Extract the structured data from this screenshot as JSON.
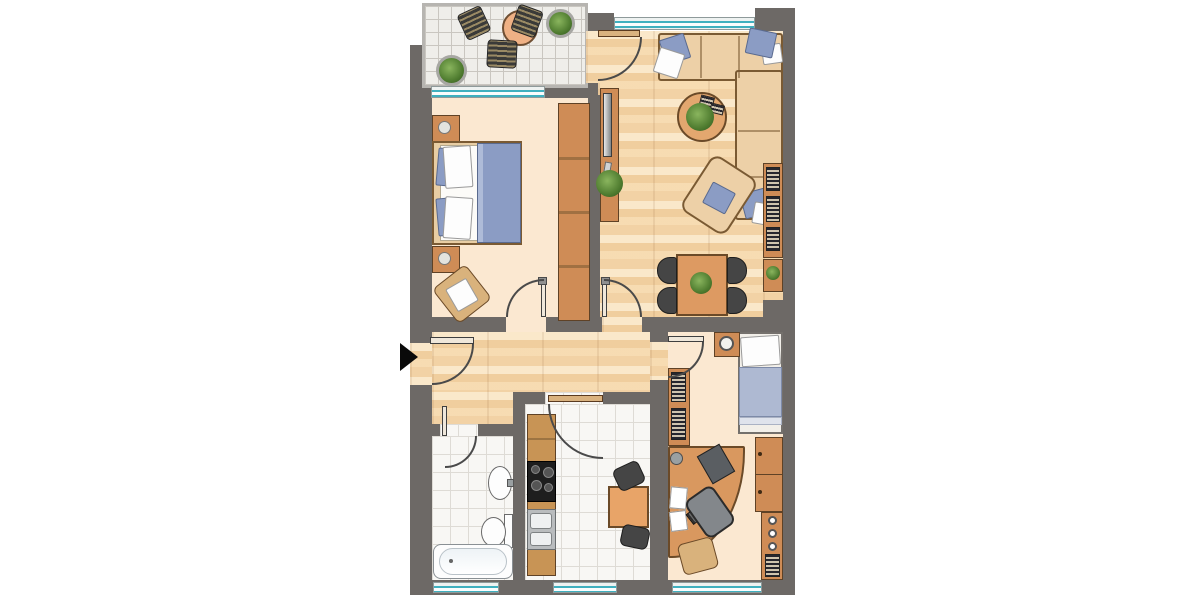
{
  "colors": {
    "wall": "#6d6966",
    "floor_cream": "#fbe8d1",
    "wood": "#f4d6ab",
    "tile": "#f8f7f4",
    "tile_line": "#dedbd5",
    "balcony_tile": "#efeeea",
    "balcony_line": "#c9c6c0",
    "window_glass": "#3fb0bf",
    "furniture_wood": "#cf8c56",
    "furniture_wood_dark": "#5f4226",
    "sofa": "#edd0a7",
    "sofa_outline": "#7a5a33",
    "textile_blue": "#8b9cc4",
    "appliance_gray": "#b9bcbe",
    "stove_black": "#1e1e1e",
    "chair_dark": "#454545",
    "table_peach": "#efb185",
    "plant_green": "#4e7b2f",
    "entrance_arrow": "#0a0a0a"
  },
  "plan": {
    "type": "apartment-floor-plan",
    "entrance_marker": "black-right-arrow",
    "rooms": [
      {
        "id": "balcony",
        "floor": "gray-tiles",
        "furniture": [
          "round-table",
          "wicker-chair",
          "wicker-chair",
          "wicker-chair",
          "potted-plant",
          "potted-plant"
        ]
      },
      {
        "id": "bedroom",
        "floor": "cream",
        "features": [
          "window",
          "door-to-hall"
        ],
        "furniture": [
          "double-bed",
          "pillows",
          "blue-blanket",
          "nightstand-with-lamp",
          "nightstand-with-lamp",
          "wicker-armchair",
          "wardrobe-four-sections"
        ]
      },
      {
        "id": "living-room",
        "floor": "wood-planks",
        "features": [
          "window",
          "balcony-door",
          "door-to-hall"
        ],
        "furniture": [
          "corner-sofa",
          "cushions",
          "round-coffee-table-with-plant",
          "books",
          "armchair",
          "tv-sideboard",
          "tv",
          "remote",
          "floor-plant",
          "bookshelf",
          "side-table-with-plant",
          "dining-table-with-plant",
          "dining-chair",
          "dining-chair",
          "dining-chair",
          "dining-chair"
        ]
      },
      {
        "id": "hallway",
        "floor": "wood-planks",
        "features": [
          "entrance-door"
        ]
      },
      {
        "id": "bathroom",
        "floor": "white-tiles",
        "features": [
          "window",
          "door"
        ],
        "furniture": [
          "washbasin",
          "toilet",
          "bathtub"
        ]
      },
      {
        "id": "kitchen",
        "floor": "white-tiles",
        "features": [
          "window",
          "door"
        ],
        "furniture": [
          "kitchenette-counter",
          "stove-four-burners",
          "double-sink",
          "square-table",
          "chair",
          "chair"
        ]
      },
      {
        "id": "office-bedroom",
        "floor": "cream",
        "features": [
          "window",
          "door"
        ],
        "furniture": [
          "single-bed",
          "nightstand-with-round-lamp",
          "bookshelf",
          "corner-desk",
          "monitor",
          "keyboard",
          "papers",
          "desk-lamp",
          "office-chair",
          "stool",
          "cabinet",
          "cabinet",
          "shelf-with-knobs"
        ]
      }
    ]
  }
}
